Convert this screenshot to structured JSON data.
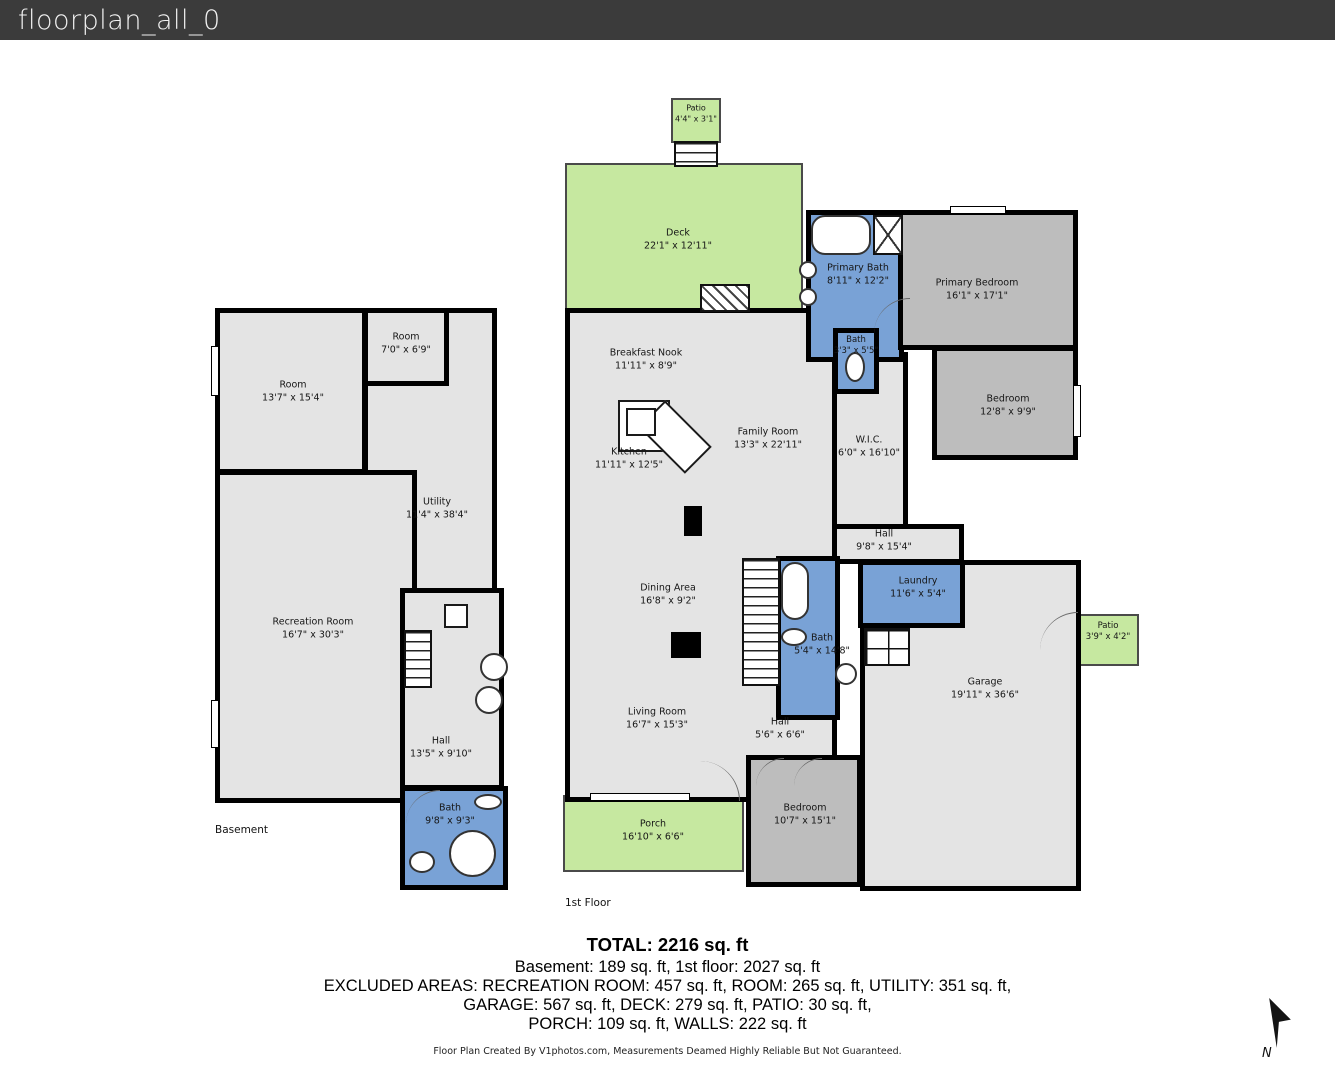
{
  "window": {
    "title": "floorplan_all_0"
  },
  "colors": {
    "titlebar": "#3b3b3b",
    "wall": "#000000",
    "floor": "#e4e4e4",
    "bedroom": "#bdbdbd",
    "bath": "#79a2d6",
    "outdoor": "#c6e8a0"
  },
  "plans": [
    {
      "name": "basement",
      "caption": {
        "text": "Basement",
        "x": 215,
        "y": 824
      },
      "rooms": [
        {
          "id": "basement-utility",
          "label": "Utility",
          "dims": "11'4\" x 38'4\"",
          "x": 363,
          "y": 308,
          "w": 134,
          "h": 287,
          "lx": 437,
          "ly": 509
        },
        {
          "id": "basement-room-small",
          "label": "Room",
          "dims": "7'0\" x 6'9\"",
          "x": 363,
          "y": 308,
          "w": 86,
          "h": 78,
          "lx": 406,
          "ly": 344
        },
        {
          "id": "basement-room",
          "label": "Room",
          "dims": "13'7\" x 15'4\"",
          "x": 215,
          "y": 308,
          "w": 152,
          "h": 166,
          "lx": 293,
          "ly": 392
        },
        {
          "id": "basement-recreation-room",
          "label": "Recreation Room",
          "dims": "16'7\" x 30'3\"",
          "x": 215,
          "y": 470,
          "w": 202,
          "h": 333,
          "lx": 313,
          "ly": 629
        },
        {
          "id": "basement-hall",
          "label": "Hall",
          "dims": "13'5\" x 9'10\"",
          "x": 400,
          "y": 588,
          "w": 104,
          "h": 202,
          "lx": 441,
          "ly": 748
        },
        {
          "id": "basement-bath",
          "label": "Bath",
          "dims": "9'8\" x 9'3\"",
          "x": 400,
          "y": 786,
          "w": 108,
          "h": 104,
          "fill": "bath",
          "lx": 450,
          "ly": 815
        }
      ],
      "fixtures": [
        {
          "id": "basement-stairs",
          "kind": "stairs",
          "x": 404,
          "y": 630,
          "w": 28,
          "h": 58
        },
        {
          "id": "basement-landing",
          "kind": "whitebox",
          "x": 444,
          "y": 604,
          "w": 24,
          "h": 24
        },
        {
          "id": "washer",
          "kind": "circle",
          "x": 480,
          "y": 653,
          "w": 28,
          "h": 28
        },
        {
          "id": "dryer",
          "kind": "circle",
          "x": 475,
          "y": 686,
          "w": 28,
          "h": 28
        },
        {
          "id": "toilet",
          "kind": "oval",
          "x": 474,
          "y": 794,
          "w": 28,
          "h": 16
        },
        {
          "id": "round-tub",
          "kind": "circle",
          "x": 449,
          "y": 830,
          "w": 47,
          "h": 47
        },
        {
          "id": "sink",
          "kind": "oval",
          "x": 409,
          "y": 851,
          "w": 26,
          "h": 22
        },
        {
          "id": "door-arc",
          "kind": "arc",
          "x": 406,
          "y": 790,
          "w": 34,
          "h": 34,
          "rot": 0
        },
        {
          "id": "window",
          "kind": "window",
          "x": 211,
          "y": 346,
          "w": 8,
          "h": 50
        },
        {
          "id": "window",
          "kind": "window",
          "x": 211,
          "y": 700,
          "w": 8,
          "h": 48
        }
      ]
    },
    {
      "name": "first-floor",
      "caption": {
        "text": "1st Floor",
        "x": 565,
        "y": 897
      },
      "rooms": [
        {
          "id": "deck",
          "label": "Deck",
          "dims": "22'1\" x 12'11\"",
          "x": 565,
          "y": 163,
          "w": 238,
          "h": 148,
          "fill": "outdoor",
          "lx": 678,
          "ly": 240
        },
        {
          "id": "patio-upper",
          "label": "Patio",
          "dims": "4'4\" x 3'1\"",
          "x": 671,
          "y": 98,
          "w": 50,
          "h": 45,
          "fill": "outdoor",
          "lx": 696,
          "ly": 114,
          "fs": 8
        },
        {
          "id": "main-floor",
          "x": 565,
          "y": 308,
          "w": 272,
          "h": 494
        },
        {
          "id": "wic",
          "label": "W.I.C.",
          "dims": "6'0\" x 16'10\"",
          "x": 832,
          "y": 352,
          "w": 76,
          "h": 178,
          "lx": 869,
          "ly": 447
        },
        {
          "id": "hall-upper-area",
          "x": 832,
          "y": 524,
          "w": 132,
          "h": 40
        },
        {
          "id": "garage",
          "label": "Garage",
          "dims": "19'11\" x 36'6\"",
          "x": 860,
          "y": 560,
          "w": 221,
          "h": 331,
          "lx": 985,
          "ly": 689
        },
        {
          "id": "primary-bath",
          "label": "Primary Bath",
          "dims": "8'11\" x 12'2\"",
          "x": 806,
          "y": 210,
          "w": 98,
          "h": 152,
          "fill": "bath",
          "lx": 858,
          "ly": 275
        },
        {
          "id": "primary-bedroom",
          "label": "Primary Bedroom",
          "dims": "16'1\" x 17'1\"",
          "x": 898,
          "y": 210,
          "w": 180,
          "h": 140,
          "fill": "bedroom",
          "lx": 977,
          "ly": 290
        },
        {
          "id": "bath-small",
          "label": "Bath",
          "dims": "3'3\" x 5'5\"",
          "x": 833,
          "y": 328,
          "w": 46,
          "h": 66,
          "fill": "bath",
          "lx": 856,
          "ly": 346,
          "fs": 8.5
        },
        {
          "id": "bedroom-2",
          "label": "Bedroom",
          "dims": "12'8\" x 9'9\"",
          "x": 932,
          "y": 346,
          "w": 146,
          "h": 114,
          "fill": "bedroom",
          "lx": 1008,
          "ly": 406
        },
        {
          "id": "bath-main",
          "label": "Bath",
          "dims": "5'4\" x 14'8\"",
          "x": 776,
          "y": 556,
          "w": 64,
          "h": 164,
          "fill": "bath",
          "lx": 822,
          "ly": 645
        },
        {
          "id": "laundry",
          "label": "Laundry",
          "dims": "11'6\" x 5'4\"",
          "x": 858,
          "y": 560,
          "w": 107,
          "h": 68,
          "fill": "bath",
          "lx": 918,
          "ly": 588
        },
        {
          "id": "patio-side",
          "label": "Patio",
          "dims": "3'9\" x 4'2\"",
          "x": 1079,
          "y": 614,
          "w": 60,
          "h": 52,
          "fill": "outdoor",
          "lx": 1108,
          "ly": 632,
          "fs": 8.5
        },
        {
          "id": "bedroom-3",
          "label": "Bedroom",
          "dims": "10'7\" x 15'1\"",
          "x": 746,
          "y": 755,
          "w": 116,
          "h": 132,
          "fill": "bedroom",
          "lx": 805,
          "ly": 815
        },
        {
          "id": "porch",
          "label": "Porch",
          "dims": "16'10\" x 6'6\"",
          "x": 563,
          "y": 795,
          "w": 181,
          "h": 77,
          "fill": "outdoor",
          "lx": 653,
          "ly": 831
        },
        {
          "id": "breakfast-nook",
          "label": "Breakfast Nook",
          "dims": "11'11\" x 8'9\"",
          "lx": 646,
          "ly": 360
        },
        {
          "id": "kitchen",
          "label": "Kitchen",
          "dims": "11'11\" x 12'5\"",
          "lx": 629,
          "ly": 459
        },
        {
          "id": "family-room",
          "label": "Family Room",
          "dims": "13'3\" x 22'11\"",
          "lx": 768,
          "ly": 439
        },
        {
          "id": "hall-upper",
          "label": "Hall",
          "dims": "9'8\" x 15'4\"",
          "lx": 884,
          "ly": 541
        },
        {
          "id": "dining-area",
          "label": "Dining Area",
          "dims": "16'8\" x 9'2\"",
          "lx": 668,
          "ly": 595
        },
        {
          "id": "living-room",
          "label": "Living Room",
          "dims": "16'7\" x 15'3\"",
          "lx": 657,
          "ly": 719
        },
        {
          "id": "hall-lower",
          "label": "Hall",
          "dims": "5'6\" x 6'6\"",
          "lx": 780,
          "ly": 729
        }
      ],
      "fixtures": [
        {
          "id": "patio-stairs",
          "kind": "stairs",
          "x": 674,
          "y": 141,
          "w": 44,
          "h": 26
        },
        {
          "id": "fireplace",
          "kind": "hatch",
          "x": 700,
          "y": 284,
          "w": 50,
          "h": 28
        },
        {
          "id": "bathtub",
          "kind": "tub",
          "x": 811,
          "y": 215,
          "w": 60,
          "h": 40
        },
        {
          "id": "shower",
          "kind": "shower",
          "x": 873,
          "y": 215,
          "w": 30,
          "h": 40
        },
        {
          "id": "sink",
          "kind": "circle",
          "x": 799,
          "y": 261,
          "w": 18,
          "h": 18
        },
        {
          "id": "sink",
          "kind": "circle",
          "x": 799,
          "y": 288,
          "w": 18,
          "h": 18
        },
        {
          "id": "toilet",
          "kind": "oval",
          "x": 845,
          "y": 352,
          "w": 20,
          "h": 30
        },
        {
          "id": "main-stairs",
          "kind": "stairs",
          "x": 742,
          "y": 558,
          "w": 38,
          "h": 128
        },
        {
          "id": "bathtub",
          "kind": "tub",
          "x": 781,
          "y": 562,
          "w": 28,
          "h": 58
        },
        {
          "id": "toilet",
          "kind": "oval",
          "x": 781,
          "y": 628,
          "w": 26,
          "h": 18
        },
        {
          "id": "sink",
          "kind": "circle",
          "x": 835,
          "y": 663,
          "w": 22,
          "h": 22
        },
        {
          "id": "garage-steps",
          "kind": "grid",
          "x": 864,
          "y": 628,
          "w": 46,
          "h": 38
        },
        {
          "id": "kitchen-counter",
          "kind": "whitebox",
          "x": 618,
          "y": 400,
          "w": 52,
          "h": 52
        },
        {
          "id": "kitchen-counter-angled",
          "kind": "whitebox",
          "x": 642,
          "y": 418,
          "w": 66,
          "h": 38,
          "rot": 45
        },
        {
          "id": "kitchen-sink-box",
          "kind": "whitebox",
          "x": 626,
          "y": 408,
          "w": 30,
          "h": 28
        },
        {
          "id": "kitchen-pillar",
          "kind": "blackbox",
          "x": 684,
          "y": 506,
          "w": 18,
          "h": 30
        },
        {
          "id": "dining-pillar",
          "kind": "blackbox",
          "x": 671,
          "y": 632,
          "w": 30,
          "h": 26
        },
        {
          "id": "entry-door-arc",
          "kind": "arc",
          "x": 700,
          "y": 761,
          "w": 40,
          "h": 40,
          "rot": 90
        },
        {
          "id": "patio-door-arc",
          "kind": "arc",
          "x": 1040,
          "y": 612,
          "w": 38,
          "h": 38,
          "rot": 0
        },
        {
          "id": "bath-door-arc",
          "kind": "arc",
          "x": 874,
          "y": 298,
          "w": 36,
          "h": 36,
          "rot": 0
        },
        {
          "id": "closet-door-arc",
          "kind": "arc",
          "x": 756,
          "y": 758,
          "w": 28,
          "h": 28,
          "rot": 0
        },
        {
          "id": "closet-door-arc",
          "kind": "arc",
          "x": 794,
          "y": 758,
          "w": 28,
          "h": 28,
          "rot": 0
        },
        {
          "id": "window",
          "kind": "window",
          "x": 950,
          "y": 206,
          "w": 56,
          "h": 8
        },
        {
          "id": "window",
          "kind": "window",
          "x": 1073,
          "y": 385,
          "w": 8,
          "h": 52
        },
        {
          "id": "window",
          "kind": "window",
          "x": 590,
          "y": 793,
          "w": 100,
          "h": 8
        }
      ]
    }
  ],
  "summary": {
    "total": "TOTAL: 2216 sq. ft",
    "line1": "Basement: 189 sq. ft, 1st floor: 2027 sq. ft",
    "line2": "EXCLUDED AREAS: RECREATION ROOM: 457 sq. ft, ROOM: 265 sq. ft, UTILITY: 351 sq. ft,",
    "line3": "GARAGE: 567 sq. ft, DECK: 279 sq. ft, PATIO: 30 sq. ft,",
    "line4": "PORCH: 109 sq. ft, WALLS: 222 sq. ft"
  },
  "footer": "Floor Plan Created By V1photos.com, Measurements Deamed Highly Reliable But Not Guaranteed.",
  "compass": {
    "label": "N"
  }
}
